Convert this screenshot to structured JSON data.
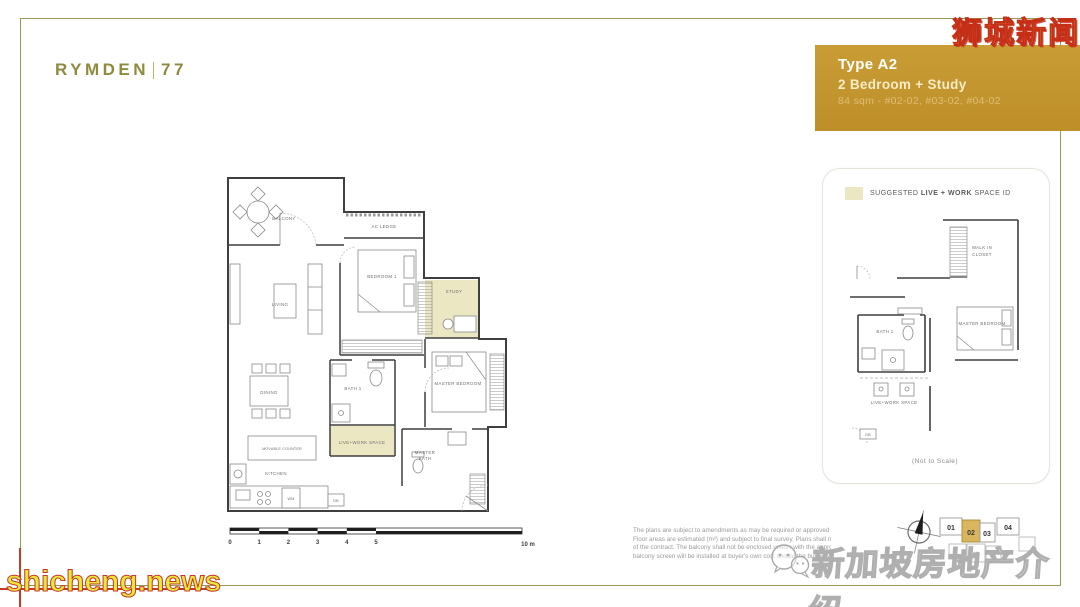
{
  "logo": {
    "name": "Rymden",
    "number": "77"
  },
  "banner": {
    "title": "Type A2",
    "subtitle": "2 Bedroom + Study",
    "details": "84 sqm - #02-02, #03-02, #04-02"
  },
  "watermarks": {
    "top_right": "狮城新闻",
    "bottom_left": "shicheng.news",
    "bottom_right": "新加坡房地产介绍"
  },
  "main_plan": {
    "labels": {
      "balcony": "BALCONY",
      "ac_ledge": "AC LEDGE",
      "living": "LIVING",
      "bedroom1": "BEDROOM 1",
      "study": "STUDY",
      "dining": "DINING",
      "bath1": "BATH 1",
      "master_bedroom": "MASTER BEDROOM",
      "live_work": "LIVE+WORK SPACE",
      "movable_counter": "MOVABLE COUNTER",
      "kitchen": "KITCHEN",
      "wm": "WM",
      "db": "DB",
      "master_bath_l1": "MASTER",
      "master_bath_l2": "BATH"
    },
    "scale_bar": {
      "ticks": [
        "0",
        "1",
        "2",
        "3",
        "4",
        "5"
      ],
      "end": "10 m"
    }
  },
  "side_panel": {
    "legend_prefix": "SUGGESTED ",
    "legend_bold": "LIVE + WORK",
    "legend_suffix": " SPACE ID",
    "labels": {
      "walk_in_l1": "WALK IN",
      "walk_in_l2": "CLOSET",
      "bath1": "BATH 1",
      "master_bedroom": "MASTER BEDROOM",
      "live_work": "LIVE+WORK SPACE",
      "db": "DB"
    },
    "note": "(Not to Scale)"
  },
  "unit_map": {
    "units": {
      "u0": "01",
      "u1": "02",
      "u2": "03",
      "u3": "04",
      "u4": "06",
      "u5": "07"
    },
    "highlighted": "02"
  },
  "disclaimer": {
    "l1": "The plans are subject to amendments as may be required or approved by the",
    "l2": "Floor areas are estimated (m²) and subject to final survey. Plans shall not",
    "l3": "of the contract. The balcony shall not be enclosed unless with the approved",
    "l4": "balcony screen will be installed at buyer's own cost should the buyer wish"
  },
  "colors": {
    "banner_bg": "#C2922F",
    "frame_border": "#9A9A58",
    "highlight": "#ECE7C3",
    "unit_highlight": "#D9B55E",
    "logo": "#8F8A3E"
  }
}
